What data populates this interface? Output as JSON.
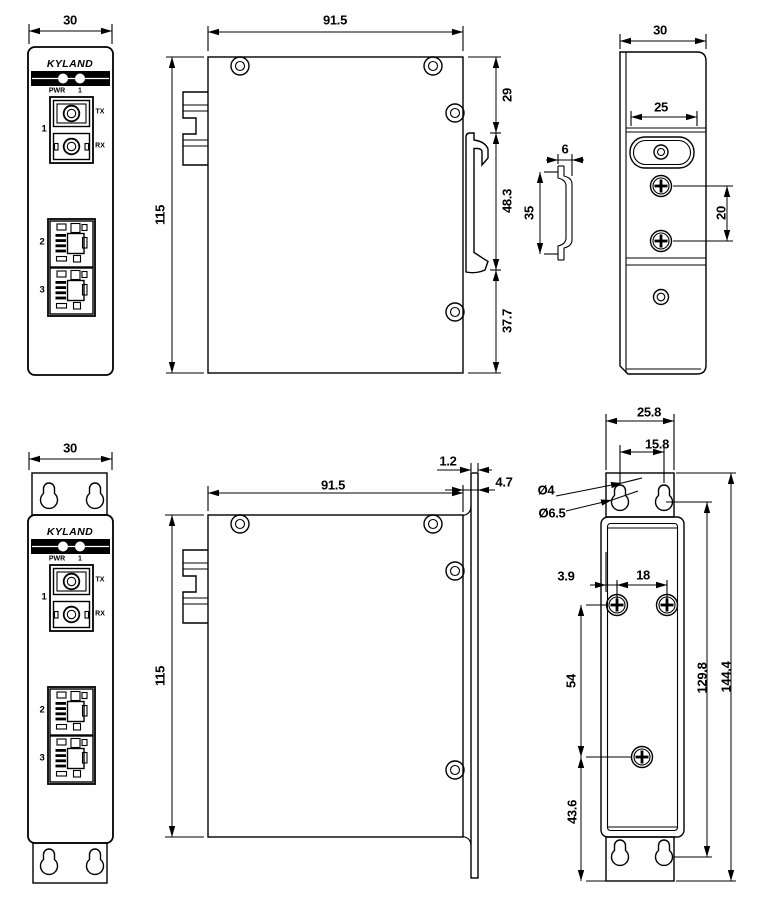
{
  "front_panel": {
    "brand": "KYLAND",
    "pwr_label": "PWR",
    "pwr_index": "1",
    "fiber_port_label": "1",
    "tx_label": "TX",
    "rx_label": "RX",
    "port2_label": "2",
    "port3_label": "3"
  },
  "views": {
    "front_din": {
      "width": "30"
    },
    "side_din": {
      "depth": "91.5",
      "height": "115",
      "top_offset": "29",
      "clip_span": "48.3",
      "bottom_offset": "37.7"
    },
    "rail_profile": {
      "depth": "6",
      "height": "35"
    },
    "back_din": {
      "width": "30",
      "bracket_width": "25",
      "screw_spacing": "20"
    },
    "front_wall": {
      "width": "30"
    },
    "side_wall": {
      "depth": "91.5",
      "height": "115",
      "plate_thickness": "1.2",
      "plate_offset": "4.7"
    },
    "back_wall": {
      "plate_width": "25.8",
      "keyhole_spacing": "15.8",
      "keyhole_small_dia": "Ø4",
      "keyhole_large_dia": "Ø6.5",
      "screw_edge_offset": "3.9",
      "screw_h_spacing": "18",
      "screw_v_spacing": "54",
      "keyhole_v_span": "129.8",
      "plate_height": "144.4",
      "bottom_offset": "43.6"
    }
  }
}
